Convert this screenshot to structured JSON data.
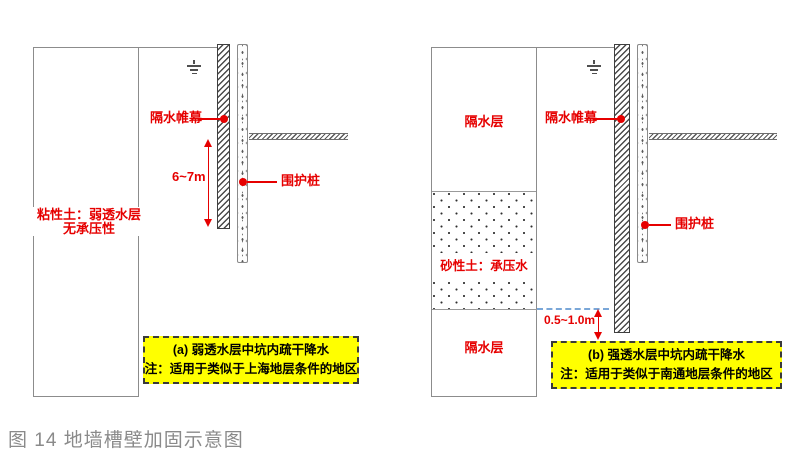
{
  "caption": "图 14 地墙槽壁加固示意图",
  "colors": {
    "label_red": "#e60000",
    "note_box_yellow": "#ffff00",
    "outline_gray": "#8c8c8c",
    "water_level_blue_dash": "#7aa7d8",
    "caption_gray": "#8a8a8a"
  },
  "icons": {
    "water_table": "groundwater-level-icon",
    "leader_dot": "red-dot-marker"
  },
  "diagram_a": {
    "curtain_label": "隔水帷幕",
    "pile_label": "围护桩",
    "depth_dim": "6~7m",
    "soil_line1": "粘性土：弱透水层",
    "soil_line2": "无承压性",
    "box_title": "(a) 弱透水层中坑内疏干降水",
    "box_note": "注：适用于类似于上海地层条件的地区"
  },
  "diagram_b": {
    "curtain_label": "隔水帷幕",
    "pile_label": "围护桩",
    "aquitard_top": "隔水层",
    "aquitard_bottom": "隔水层",
    "sand_label": "砂性土：承压水",
    "gap_dim": "0.5~1.0m",
    "box_title": "(b) 强透水层中坑内疏干降水",
    "box_note": "注：适用于类似于南通地层条件的地区"
  }
}
